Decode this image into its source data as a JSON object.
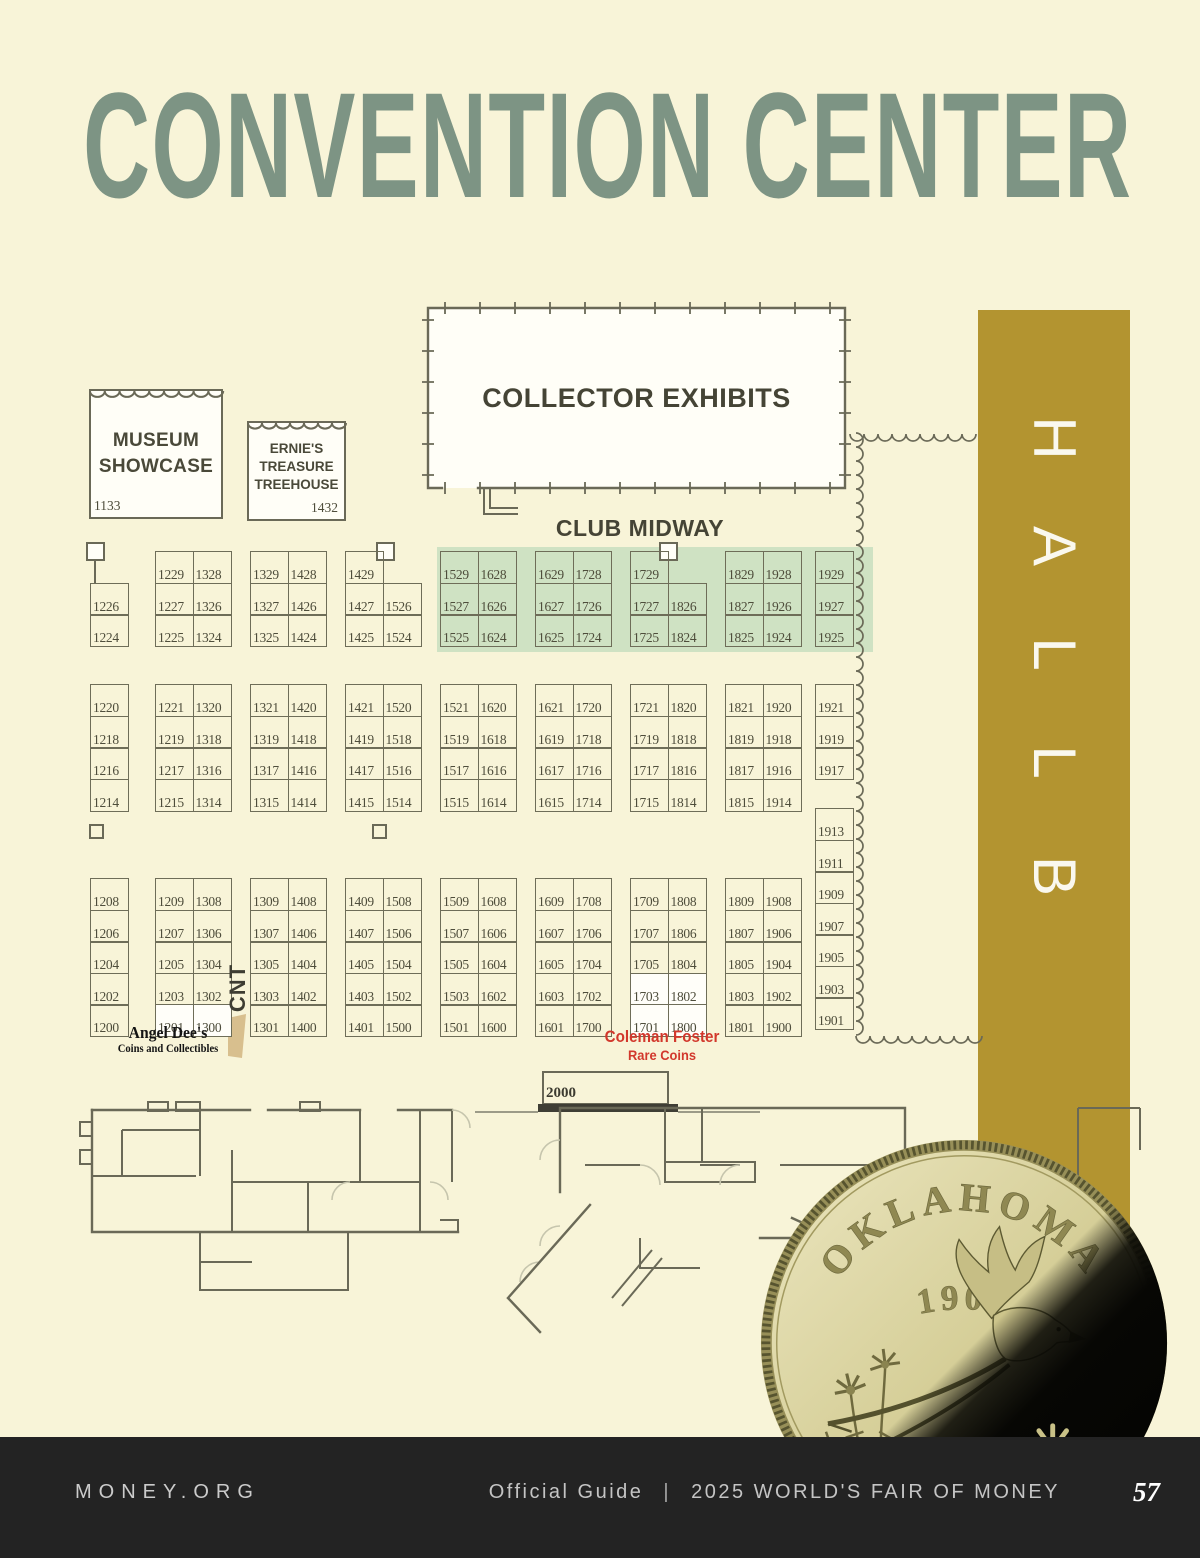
{
  "page": {
    "title": "CONVENTION CENTER",
    "background": "#f8f4d8",
    "title_color": "#7d9484"
  },
  "hall": {
    "label": "HALL B",
    "letters": [
      "H",
      "A",
      "L",
      "L",
      "B"
    ],
    "bar_color": "#b39430",
    "letter_color": "#faf8ee"
  },
  "areas": {
    "museum_showcase": {
      "label": "MUSEUM SHOWCASE",
      "booth": "1133"
    },
    "ernies_treehouse": {
      "label": "ERNIE'S TREASURE TREEHOUSE",
      "booth": "1432"
    },
    "collector_exhibits": {
      "label": "COLLECTOR EXHIBITS"
    },
    "club_midway": {
      "label": "CLUB MIDWAY"
    },
    "stage_booth": {
      "label": "2000"
    },
    "cnt": {
      "label": "CNT"
    }
  },
  "dealers": {
    "angel_dees": {
      "name": "Angel Dee's",
      "subtitle": "Coins and Collectibles",
      "booths": [
        "1201",
        "1300"
      ],
      "color": "#141414"
    },
    "coleman_foster": {
      "name": "Coleman Foster",
      "subtitle": "Rare Coins",
      "booths": [
        "1703",
        "1802",
        "1701",
        "1800"
      ],
      "color": "#d2382c"
    }
  },
  "booths": {
    "line_color": "#6e6d58",
    "number_color": "#4e4d3b",
    "club_midway_band_color": "#cfe2c3",
    "highlighted": [
      "1201",
      "1300",
      "1703",
      "1802",
      "1701",
      "1800"
    ],
    "sections": [
      {
        "id": "t1",
        "type": "single",
        "x": 90,
        "y": 551,
        "rows": [
          null,
          "1226",
          "1224"
        ],
        "square": "left"
      },
      {
        "id": "t2",
        "type": "pair",
        "x": 155,
        "y": 551,
        "rows": [
          [
            "1229",
            "1328"
          ],
          [
            "1227",
            "1326"
          ],
          [
            "1225",
            "1324"
          ]
        ]
      },
      {
        "id": "t3",
        "type": "pair",
        "x": 250,
        "y": 551,
        "rows": [
          [
            "1329",
            "1428"
          ],
          [
            "1327",
            "1426"
          ],
          [
            "1325",
            "1424"
          ]
        ]
      },
      {
        "id": "t4",
        "type": "pair",
        "x": 345,
        "y": 551,
        "rows": [
          [
            "1429",
            null
          ],
          [
            "1427",
            "1526"
          ],
          [
            "1425",
            "1524"
          ]
        ],
        "square": "right"
      },
      {
        "id": "t5",
        "type": "pair",
        "x": 440,
        "y": 551,
        "rows": [
          [
            "1529",
            "1628"
          ],
          [
            "1527",
            "1626"
          ],
          [
            "1525",
            "1624"
          ]
        ]
      },
      {
        "id": "t6",
        "type": "pair",
        "x": 535,
        "y": 551,
        "rows": [
          [
            "1629",
            "1728"
          ],
          [
            "1627",
            "1726"
          ],
          [
            "1625",
            "1724"
          ]
        ]
      },
      {
        "id": "t7",
        "type": "pair",
        "x": 630,
        "y": 551,
        "rows": [
          [
            "1729",
            null
          ],
          [
            "1727",
            "1826"
          ],
          [
            "1725",
            "1824"
          ]
        ],
        "square": "right"
      },
      {
        "id": "t8",
        "type": "pair",
        "x": 725,
        "y": 551,
        "rows": [
          [
            "1829",
            "1928"
          ],
          [
            "1827",
            "1926"
          ],
          [
            "1825",
            "1924"
          ]
        ]
      },
      {
        "id": "t9",
        "type": "single",
        "x": 815,
        "y": 551,
        "rows": [
          "1929",
          "1927",
          "1925"
        ]
      },
      {
        "id": "m1",
        "type": "single",
        "x": 90,
        "y": 684,
        "rows": [
          "1220",
          "1218",
          "1216",
          "1214"
        ]
      },
      {
        "id": "m2",
        "type": "pair",
        "x": 155,
        "y": 684,
        "rows": [
          [
            "1221",
            "1320"
          ],
          [
            "1219",
            "1318"
          ],
          [
            "1217",
            "1316"
          ],
          [
            "1215",
            "1314"
          ]
        ]
      },
      {
        "id": "m3",
        "type": "pair",
        "x": 250,
        "y": 684,
        "rows": [
          [
            "1321",
            "1420"
          ],
          [
            "1319",
            "1418"
          ],
          [
            "1317",
            "1416"
          ],
          [
            "1315",
            "1414"
          ]
        ]
      },
      {
        "id": "m4",
        "type": "pair",
        "x": 345,
        "y": 684,
        "rows": [
          [
            "1421",
            "1520"
          ],
          [
            "1419",
            "1518"
          ],
          [
            "1417",
            "1516"
          ],
          [
            "1415",
            "1514"
          ]
        ]
      },
      {
        "id": "m5",
        "type": "pair",
        "x": 440,
        "y": 684,
        "rows": [
          [
            "1521",
            "1620"
          ],
          [
            "1519",
            "1618"
          ],
          [
            "1517",
            "1616"
          ],
          [
            "1515",
            "1614"
          ]
        ]
      },
      {
        "id": "m6",
        "type": "pair",
        "x": 535,
        "y": 684,
        "rows": [
          [
            "1621",
            "1720"
          ],
          [
            "1619",
            "1718"
          ],
          [
            "1617",
            "1716"
          ],
          [
            "1615",
            "1714"
          ]
        ]
      },
      {
        "id": "m7",
        "type": "pair",
        "x": 630,
        "y": 684,
        "rows": [
          [
            "1721",
            "1820"
          ],
          [
            "1719",
            "1818"
          ],
          [
            "1717",
            "1816"
          ],
          [
            "1715",
            "1814"
          ]
        ]
      },
      {
        "id": "m8",
        "type": "pair",
        "x": 725,
        "y": 684,
        "rows": [
          [
            "1821",
            "1920"
          ],
          [
            "1819",
            "1918"
          ],
          [
            "1817",
            "1916"
          ],
          [
            "1815",
            "1914"
          ]
        ]
      },
      {
        "id": "m9",
        "type": "single",
        "x": 815,
        "y": 684,
        "rows": [
          "1921",
          "1919",
          "1917"
        ]
      },
      {
        "id": "b1",
        "type": "single",
        "x": 90,
        "y": 878,
        "rows": [
          "1208",
          "1206",
          "1204",
          "1202",
          "1200"
        ]
      },
      {
        "id": "b2",
        "type": "pair",
        "x": 155,
        "y": 878,
        "rows": [
          [
            "1209",
            "1308"
          ],
          [
            "1207",
            "1306"
          ],
          [
            "1205",
            "1304"
          ],
          [
            "1203",
            "1302"
          ],
          [
            "1201",
            "1300"
          ]
        ]
      },
      {
        "id": "b3",
        "type": "pair",
        "x": 250,
        "y": 878,
        "rows": [
          [
            "1309",
            "1408"
          ],
          [
            "1307",
            "1406"
          ],
          [
            "1305",
            "1404"
          ],
          [
            "1303",
            "1402"
          ],
          [
            "1301",
            "1400"
          ]
        ]
      },
      {
        "id": "b4",
        "type": "pair",
        "x": 345,
        "y": 878,
        "rows": [
          [
            "1409",
            "1508"
          ],
          [
            "1407",
            "1506"
          ],
          [
            "1405",
            "1504"
          ],
          [
            "1403",
            "1502"
          ],
          [
            "1401",
            "1500"
          ]
        ]
      },
      {
        "id": "b5",
        "type": "pair",
        "x": 440,
        "y": 878,
        "rows": [
          [
            "1509",
            "1608"
          ],
          [
            "1507",
            "1606"
          ],
          [
            "1505",
            "1604"
          ],
          [
            "1503",
            "1602"
          ],
          [
            "1501",
            "1600"
          ]
        ]
      },
      {
        "id": "b6",
        "type": "pair",
        "x": 535,
        "y": 878,
        "rows": [
          [
            "1609",
            "1708"
          ],
          [
            "1607",
            "1706"
          ],
          [
            "1605",
            "1704"
          ],
          [
            "1603",
            "1702"
          ],
          [
            "1601",
            "1700"
          ]
        ]
      },
      {
        "id": "b7",
        "type": "pair",
        "x": 630,
        "y": 878,
        "rows": [
          [
            "1709",
            "1808"
          ],
          [
            "1707",
            "1806"
          ],
          [
            "1705",
            "1804"
          ],
          [
            "1703",
            "1802"
          ],
          [
            "1701",
            "1800"
          ]
        ]
      },
      {
        "id": "b8",
        "type": "pair",
        "x": 725,
        "y": 878,
        "rows": [
          [
            "1809",
            "1908"
          ],
          [
            "1807",
            "1906"
          ],
          [
            "1805",
            "1904"
          ],
          [
            "1803",
            "1902"
          ],
          [
            "1801",
            "1900"
          ]
        ]
      },
      {
        "id": "b9",
        "type": "single",
        "x": 815,
        "y": 808,
        "rows": [
          "1913",
          "1911",
          "1909",
          "1907",
          "1905",
          "1903",
          "1901"
        ]
      }
    ]
  },
  "coin": {
    "state": "OKLAHOMA",
    "year": "1907"
  },
  "footer": {
    "left": "MONEY.ORG",
    "guide": "Official Guide",
    "separator": "|",
    "event": "2025 WORLD'S FAIR OF MONEY",
    "page_number": "57",
    "bg": "#232323",
    "text_color": "#c9c9c9"
  }
}
